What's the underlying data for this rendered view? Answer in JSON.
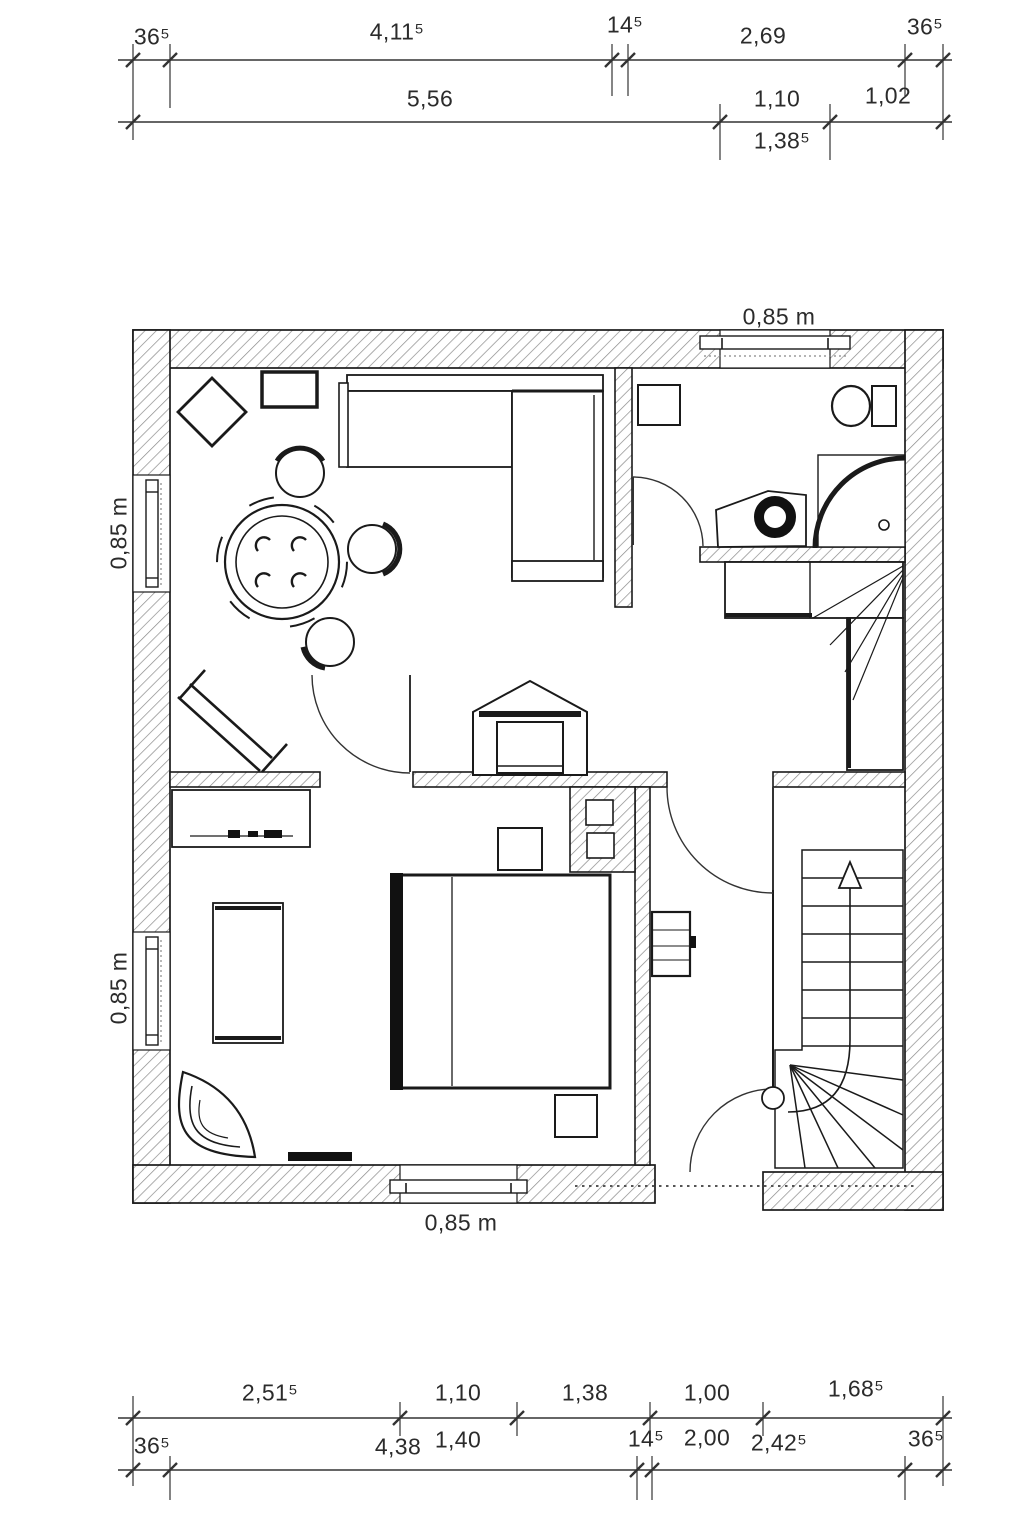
{
  "dims": {
    "top1": {
      "left_wall": "36⁵",
      "living_width": "4,11⁵",
      "partition": "14⁵",
      "bath_width": "2,69",
      "right_wall": "36⁵"
    },
    "top2": {
      "total": "5,56",
      "window": "1,10",
      "end": "1,02",
      "alt": "1,38⁵"
    },
    "bot1": {
      "a": "2,51⁵",
      "b": "1,10",
      "c": "1,38",
      "d": "1,00",
      "e": "1,68⁵",
      "b_below": "1,40",
      "d_below": "2,00"
    },
    "bot2": {
      "left_wall": "36⁵",
      "a": "4,38",
      "partition": "14⁵",
      "b": "2,42⁵",
      "right_wall": "36⁵"
    },
    "sill": {
      "top": "0,85 m",
      "left_upper": "0,85 m",
      "left_lower": "0,85 m",
      "bottom": "0,85 m"
    }
  },
  "colors": {
    "line": "#1a1a1a",
    "hatch": "#7a7a7a",
    "text": "#2b2b2b"
  }
}
